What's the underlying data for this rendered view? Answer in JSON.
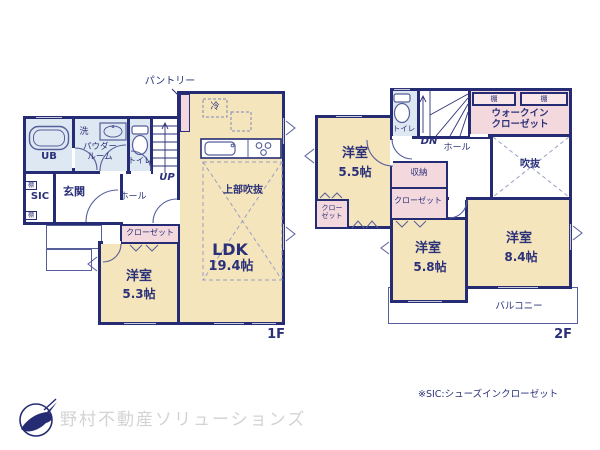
{
  "f1": {
    "label": "1F",
    "pantry": "パントリー",
    "fridge": "冷",
    "ub": "UB",
    "laundry": "洗",
    "powder1": "パウダー",
    "powder2": "ルーム",
    "toilet": "トイレ",
    "up": "UP",
    "sic": "SIC",
    "genkan": "玄関",
    "hall": "ホール",
    "closet": "クローゼット",
    "shelf": "棚",
    "room53": "洋室",
    "room53_size": "5.3帖",
    "ldk": "LDK",
    "ldk_size": "19.4帖",
    "void_upper": "上部吹抜"
  },
  "f2": {
    "label": "2F",
    "toilet": "トイレ",
    "dn": "DN",
    "hall": "ホール",
    "shelf": "棚",
    "wic1": "ウォークイン",
    "wic2": "クローゼット",
    "void": "吹抜",
    "room55": "洋室",
    "room55_size": "5.5帖",
    "storage": "収納",
    "closet": "クローゼット",
    "closet_small1": "クロー",
    "closet_small2": "ゼット",
    "room58": "洋室",
    "room58_size": "5.8帖",
    "room84": "洋室",
    "room84_size": "8.4帖",
    "balcony": "バルコニー"
  },
  "footer": {
    "note": "※SIC:シューズインクローゼット",
    "company": "野村不動産ソリューションズ"
  },
  "colors": {
    "wall": "#262c74",
    "room_fill": "#f5e5bd",
    "wet_fill": "#dde8f2",
    "closet_fill": "#f3d9dd",
    "text": "#2b3178",
    "logo_text": "#d3d3d3"
  }
}
